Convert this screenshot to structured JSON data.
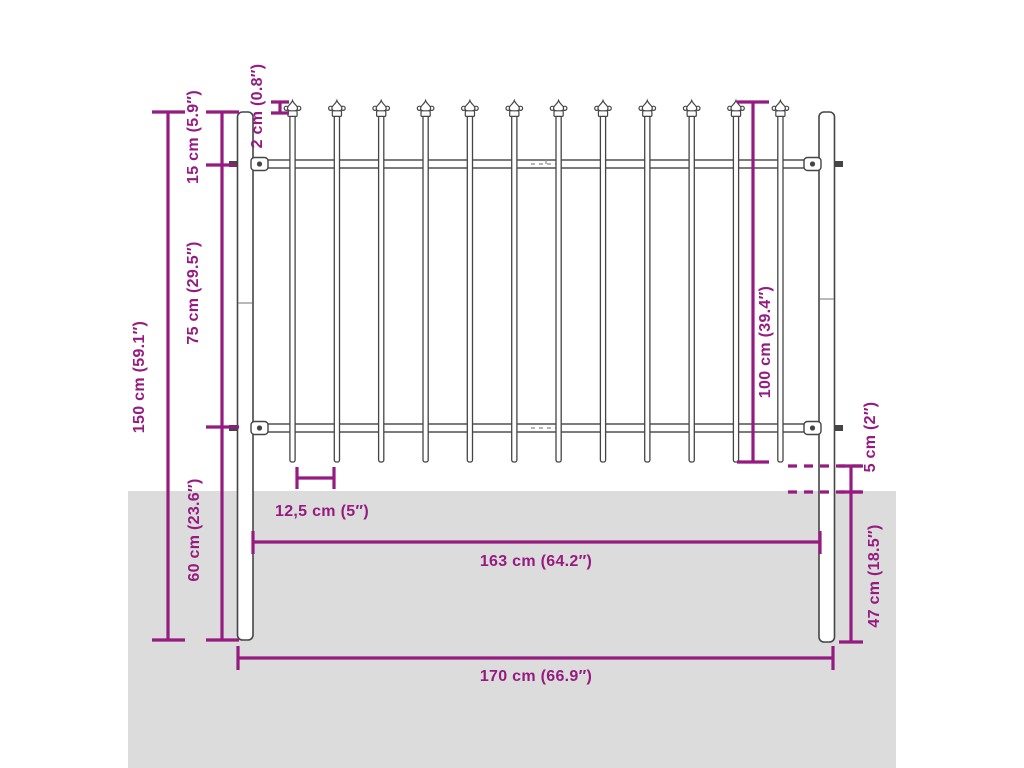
{
  "diagram": {
    "kind": "fence-panel-dimension-diagram",
    "labels": {
      "total_height": "150 cm (59.1″)",
      "top_offset": "15 cm (5.9″)",
      "upper_section": "75 cm (29.5″)",
      "below_rail_section": "60 cm (23.6″)",
      "spear_tip_height": "2 cm (0.8″)",
      "panel_height": "100 cm (39.4″)",
      "bar_spacing": "12,5 cm (5″)",
      "panel_width": "163 cm (64.2″)",
      "total_width": "170 cm (66.9″)",
      "ground_clearance": "5 cm (2″)",
      "buried_depth": "47 cm (18.5″)"
    },
    "fence": {
      "bar_count": 12,
      "post_count": 2,
      "rail_count": 2
    },
    "colors": {
      "accent": "#951B81",
      "outline": "#454545",
      "ground": "#DCDCDC",
      "background": "#FFFFFF"
    }
  }
}
